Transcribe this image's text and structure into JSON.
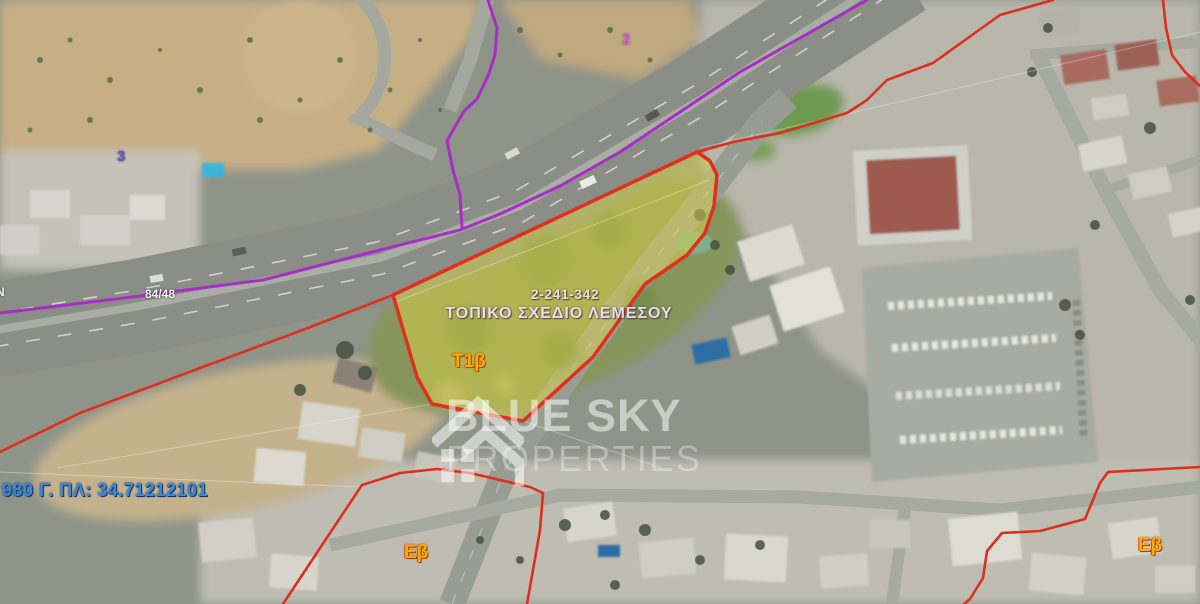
{
  "page": {
    "width": 1200,
    "height": 604,
    "kind": "satellite cadastral map with town-plan overlay"
  },
  "map": {
    "labels": {
      "block_top": "2",
      "block_left": "3",
      "road_ref": "84/48",
      "edge_partial": "N",
      "parcel_number": "2-241-342",
      "plan_title": "ΤΟΠΙΚΟ ΣΧΕΔΙΟ ΛΕΜΕΣΟΥ",
      "zone_parcel": "Τ1β",
      "zone_bottom_left": "Εβ",
      "zone_bottom_right": "Εβ",
      "coordinates": "980 Γ. ΠΛ: 34.71212101"
    },
    "colors": {
      "parcel_fill": "#d9d44a",
      "parcel_border": "#e0301c",
      "boundary_red": "#dd2f1e",
      "boundary_purple": "#a82cc8",
      "zone_label_orange": "#ffaa00",
      "coordinates_blue": "#3c87d8",
      "plan_label_cream": "#ece4cf",
      "survey_line_white": "#f5f5ef"
    }
  },
  "watermark": {
    "icon": "house-icon",
    "line1": "BLUE SKY",
    "line2": "PROPERTIES"
  }
}
